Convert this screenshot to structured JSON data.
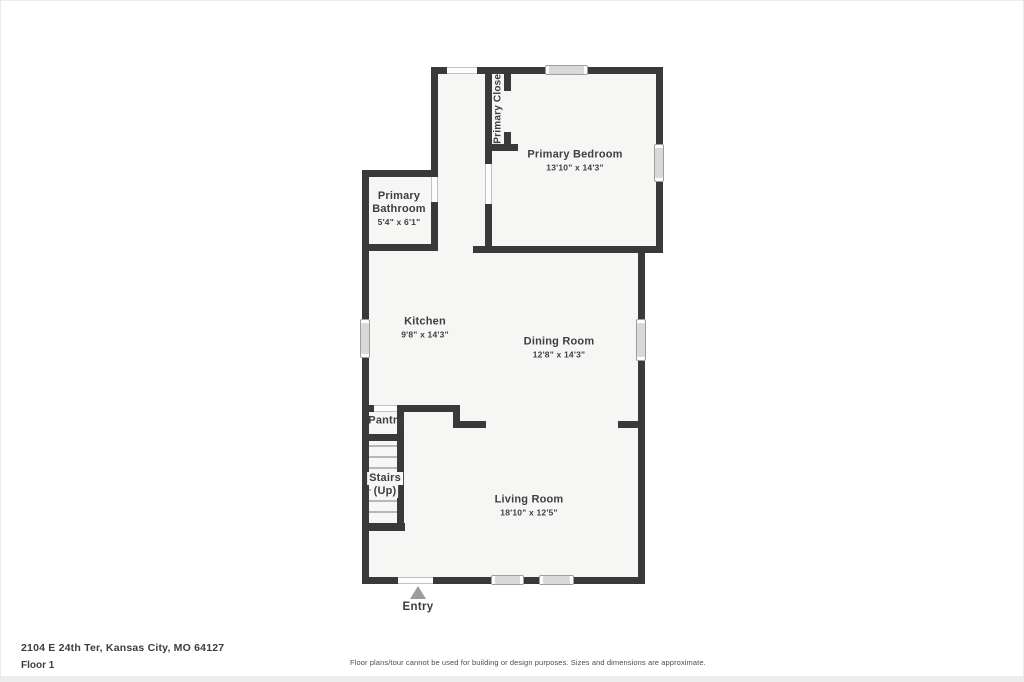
{
  "plan": {
    "rooms": {
      "primary_closet": {
        "label": "Primary Closet"
      },
      "primary_bedroom": {
        "label": "Primary Bedroom",
        "dims": "13'10\" x 14'3\""
      },
      "primary_bathroom": {
        "label": "Primary Bathroom",
        "dims": "5'4\" x 6'1\""
      },
      "kitchen": {
        "label": "Kitchen",
        "dims": "9'8\" x 14'3\""
      },
      "dining_room": {
        "label": "Dining Room",
        "dims": "12'8\" x 14'3\""
      },
      "pantry": {
        "label": "Pantry"
      },
      "stairs": {
        "label": "Stairs",
        "sublabel": "(Up)"
      },
      "living_room": {
        "label": "Living Room",
        "dims": "18'10\" x 12'5\""
      }
    },
    "entry_label": "Entry"
  },
  "footer": {
    "address": "2104 E 24th Ter, Kansas City, MO 64127",
    "floor": "Floor 1",
    "disclaimer": "Floor plans/tour cannot be used for building or design purposes. Sizes and dimensions are approximate."
  },
  "colors": {
    "wall": "#38393b",
    "floor": "#f6f6f5",
    "window_fill": "#d9d9d9",
    "window_border": "#9e9e9e",
    "text": "#3d3e40"
  }
}
